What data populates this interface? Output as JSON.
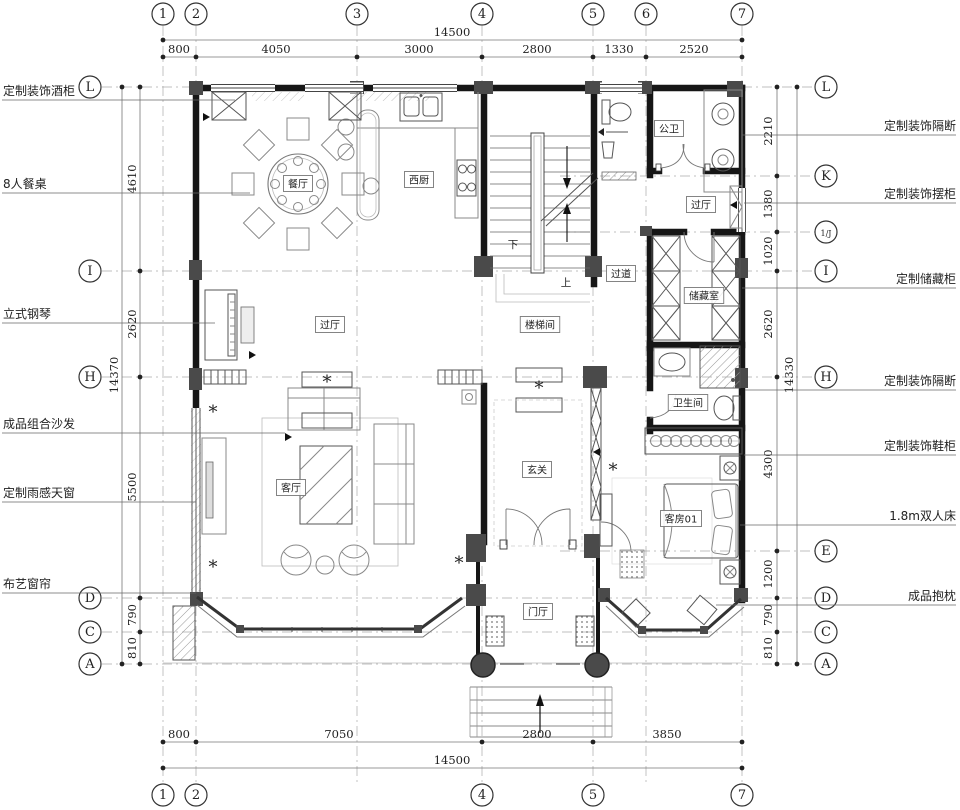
{
  "plan": {
    "colors": {
      "wall": "#161616",
      "column": "#4a4a4a",
      "furniture": "#888888",
      "grid": "#aaaaaa",
      "dim_text": "#222222"
    },
    "axis_circles": {
      "top": [
        {
          "label": "1",
          "x": 163
        },
        {
          "label": "2",
          "x": 196
        },
        {
          "label": "3",
          "x": 357
        },
        {
          "label": "4",
          "x": 482
        },
        {
          "label": "5",
          "x": 593
        },
        {
          "label": "6",
          "x": 646
        },
        {
          "label": "7",
          "x": 742
        }
      ],
      "bottom": [
        {
          "label": "1",
          "x": 163
        },
        {
          "label": "2",
          "x": 196
        },
        {
          "label": "4",
          "x": 482
        },
        {
          "label": "5",
          "x": 593
        },
        {
          "label": "7",
          "x": 742
        }
      ],
      "left": [
        {
          "label": "L",
          "y": 87
        },
        {
          "label": "I",
          "y": 271
        },
        {
          "label": "H",
          "y": 377
        },
        {
          "label": "D",
          "y": 598
        },
        {
          "label": "C",
          "y": 632
        },
        {
          "label": "A",
          "y": 664
        }
      ],
      "right": [
        {
          "label": "L",
          "y": 87
        },
        {
          "label": "K",
          "y": 176,
          "short": true
        },
        {
          "label": "1/J",
          "y": 232,
          "short": true
        },
        {
          "label": "I",
          "y": 271
        },
        {
          "label": "H",
          "y": 377
        },
        {
          "label": "E",
          "y": 551,
          "short": true
        },
        {
          "label": "D",
          "y": 598
        },
        {
          "label": "C",
          "y": 632
        },
        {
          "label": "A",
          "y": 664
        }
      ]
    },
    "dimensions": {
      "top_total": {
        "value": "14500",
        "x": 452,
        "y": 36
      },
      "top_segments": [
        {
          "value": "800",
          "x": 179
        },
        {
          "value": "4050",
          "x": 276
        },
        {
          "value": "3000",
          "x": 419
        },
        {
          "value": "2800",
          "x": 537
        },
        {
          "value": "1330",
          "x": 619
        },
        {
          "value": "2520",
          "x": 694
        }
      ],
      "bottom_segments": [
        {
          "value": "800",
          "x": 179
        },
        {
          "value": "7050",
          "x": 339
        },
        {
          "value": "2800",
          "x": 537
        },
        {
          "value": "3850",
          "x": 667
        }
      ],
      "bottom_total": {
        "value": "14500",
        "x": 452,
        "y": 764
      },
      "bottom_ticks": [
        163,
        196,
        482,
        593,
        742
      ],
      "left_segments": [
        {
          "value": "4610",
          "y": 179
        },
        {
          "value": "2620",
          "y": 324
        },
        {
          "value": "5500",
          "y": 487
        },
        {
          "value": "790",
          "y": 615
        },
        {
          "value": "810",
          "y": 648
        }
      ],
      "left_total": {
        "value": "14370",
        "x": 118,
        "y": 375
      },
      "right_segments": [
        {
          "value": "2210",
          "y": 131
        },
        {
          "value": "1380",
          "y": 204
        },
        {
          "value": "1020",
          "y": 251
        },
        {
          "value": "2620",
          "y": 324
        },
        {
          "value": "4300",
          "y": 464
        },
        {
          "value": "1200",
          "y": 574
        },
        {
          "value": "790",
          "y": 615
        },
        {
          "value": "810",
          "y": 648
        }
      ],
      "right_total": {
        "value": "14330",
        "x": 793,
        "y": 375
      }
    },
    "callouts": {
      "left": [
        {
          "text": "定制装饰酒柜",
          "y": 95,
          "lx2": 235
        },
        {
          "text": "8人餐桌",
          "y": 188,
          "lx2": 250
        },
        {
          "text": "立式钢琴",
          "y": 318,
          "lx2": 215
        },
        {
          "text": "成品组合沙发",
          "y": 428,
          "lx2": 285
        },
        {
          "text": "定制雨感天窗",
          "y": 497,
          "lx2": 196
        },
        {
          "text": "布艺窗帘",
          "y": 588,
          "lx2": 196
        }
      ],
      "right": [
        {
          "text": "定制装饰隔断",
          "y": 130,
          "lx1": 742
        },
        {
          "text": "定制装饰摆柜",
          "y": 198,
          "lx1": 744
        },
        {
          "text": "定制储藏柜",
          "y": 283,
          "lx1": 742
        },
        {
          "text": "定制装饰隔断",
          "y": 385,
          "lx1": 745
        },
        {
          "text": "定制装饰鞋柜",
          "y": 450,
          "lx1": 744
        },
        {
          "text": "1.8m双人床",
          "y": 520,
          "lx1": 740
        },
        {
          "text": "成品抱枕",
          "y": 600,
          "lx1": 716
        }
      ]
    },
    "rooms": [
      {
        "name": "餐厅",
        "x": 298,
        "y": 184
      },
      {
        "name": "西厨",
        "x": 419,
        "y": 180
      },
      {
        "name": "公卫",
        "x": 669,
        "y": 129
      },
      {
        "name": "过厅",
        "x": 701,
        "y": 205
      },
      {
        "name": "过道",
        "x": 621,
        "y": 274
      },
      {
        "name": "储藏室",
        "x": 704,
        "y": 296
      },
      {
        "name": "楼梯间",
        "x": 540,
        "y": 325
      },
      {
        "name": "过厅",
        "x": 330,
        "y": 325
      },
      {
        "name": "卫生间",
        "x": 688,
        "y": 403
      },
      {
        "name": "玄关",
        "x": 537,
        "y": 470
      },
      {
        "name": "客厅",
        "x": 291,
        "y": 488
      },
      {
        "name": "客房01",
        "x": 681,
        "y": 519
      },
      {
        "name": "门厅",
        "x": 538,
        "y": 612
      }
    ],
    "stair_labels": [
      {
        "text": "下",
        "x": 513,
        "y": 248
      },
      {
        "text": "上",
        "x": 566,
        "y": 286
      }
    ]
  }
}
